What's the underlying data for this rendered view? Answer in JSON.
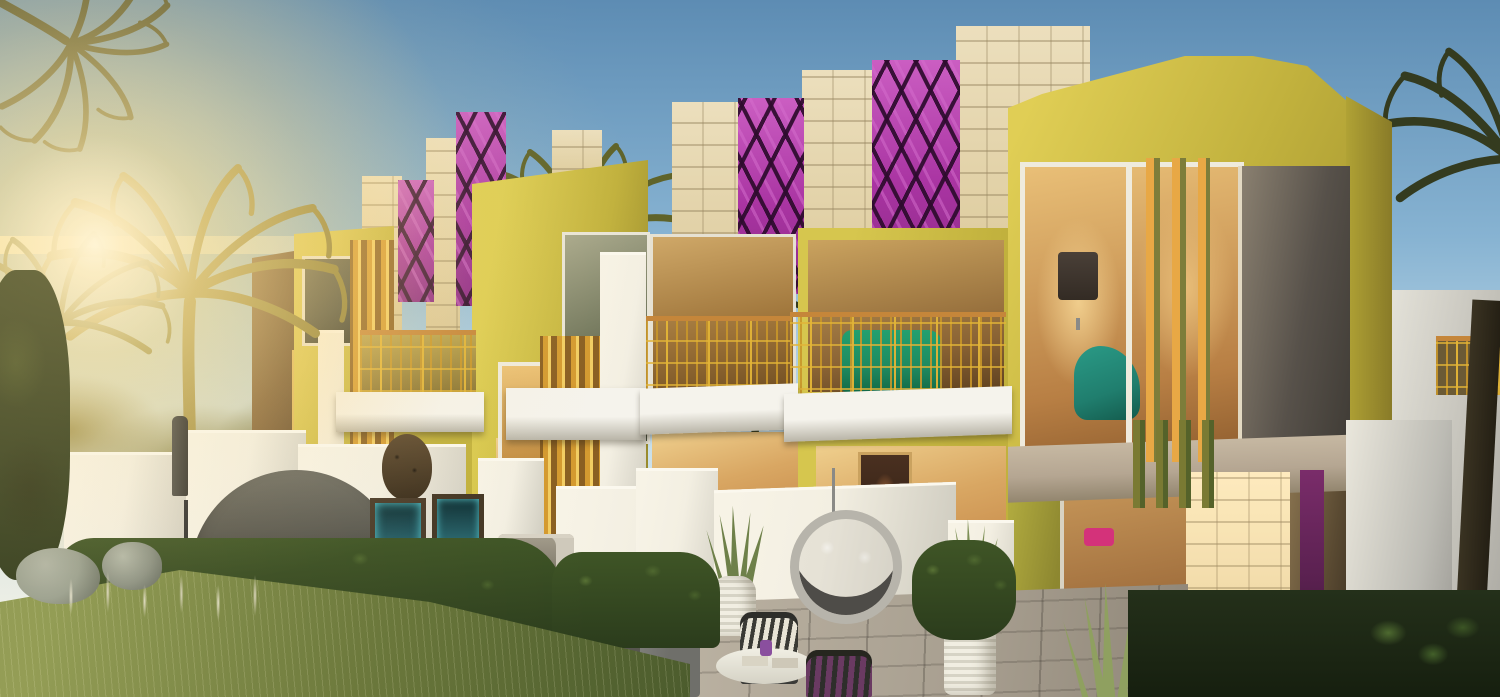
{
  "meta": {
    "image_type": "architectural-rendering",
    "description": "Sunset exterior rendering of a row of modern two-storey townhouses with chartreuse stucco facades, purple snakeskin-print feature panels, cream limestone pillars, gold geometric balcony railings and landscaped private terraces framed by palm trees"
  },
  "scene": {
    "time_of_day": "low golden sun at left with lens glare",
    "objects": [
      "sun-glare",
      "palm-trees-left",
      "palm-tree-right",
      "distant-shrubs",
      "townhouse-row",
      "snakeskin-panels",
      "limestone-parapets",
      "gold-balcony-railings",
      "white-balcony-slabs",
      "gold-louver-fins",
      "corner-unit-bedroom-window",
      "floor-lamp",
      "teal-chaise",
      "green-balcony-sofa",
      "dining-room-interior",
      "stone-corner-pillar",
      "plum-entry-door",
      "privacy-walls",
      "canopy-daybed",
      "closed-patio-umbrella",
      "rattan-egg-chair",
      "metal-ring-swing-chair",
      "water-feature-panels",
      "bbq-grill-station",
      "round-coffee-table",
      "patio-chairs",
      "white-planters",
      "snake-plants",
      "stone-pavers",
      "hedges",
      "lawn",
      "boulders",
      "ornamental-grasses",
      "foreground-foliage"
    ]
  },
  "colors": {
    "sky-top": "#5d8cb3",
    "sky-mid": "#87b3d2",
    "sky-low": "#c5dde9",
    "sky-horizon": "#edf1ec",
    "sun-core": "#fffdf2",
    "sun-glow": "#ffe8b5",
    "facade-lit": "#d6c64e",
    "facade-mid": "#c1b13d",
    "facade-shadow": "#96882c",
    "facade-warm": "#dcb75a",
    "gold-fin": "#d49a30",
    "gold-rail": "#e2b437",
    "wood-rail": "#c5863a",
    "stone-cream": "#ecdfbd",
    "stone-warm": "#d9c695",
    "purple-base": "#a934a2",
    "purple-light": "#cb5ec2",
    "purple-dark": "#2d0b2d",
    "white-wall": "#f3efe2",
    "white-shade": "#cfccc0",
    "slab-white": "#f5f3ec",
    "slab-under": "#b9b5a8",
    "taupe": "#b5a692",
    "glass-dark": "#3f453d",
    "glass-warm": "#d9a763",
    "interior-warm": "#c98e4d",
    "interior-deep": "#7e5023",
    "green-sofa": "#1e8a60",
    "teal-chaise": "#207e6e",
    "hedge-dark": "#2b3c1c",
    "hedge-mid": "#3f5526",
    "grass-lit": "#8b9850",
    "grass-dark": "#4c5c2d",
    "paver": "#a89f90",
    "paver-light": "#beb5a5",
    "trunk": "#463623",
    "palm-gold": "#857a33",
    "palm-mid": "#5f6329",
    "palm-dark": "#343b1f",
    "boulder": "#99a091",
    "daybed": "#5a5951",
    "metal": "#a3a19b",
    "plum": "#5a2150",
    "corner-panel": "#57514a"
  }
}
